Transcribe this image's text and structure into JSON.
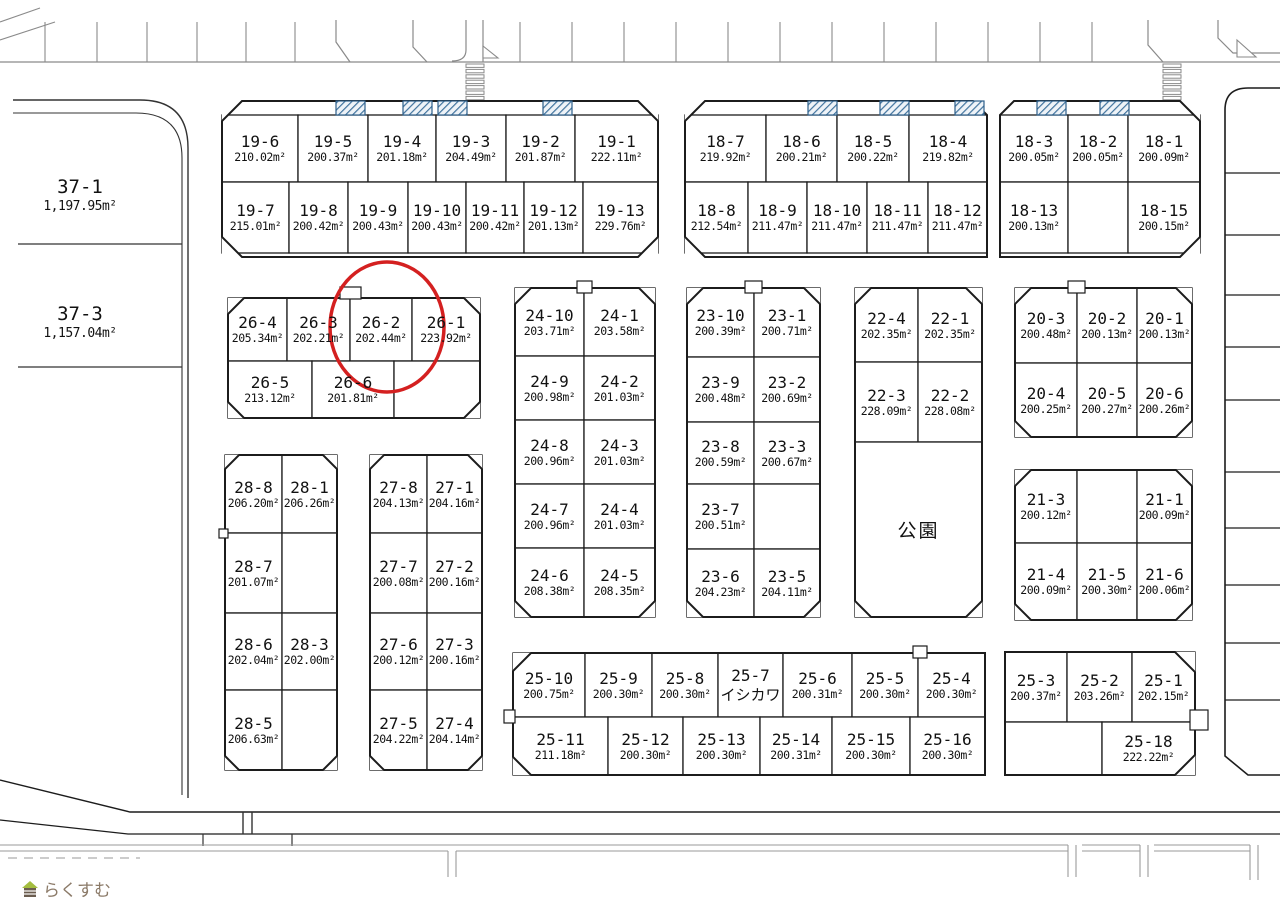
{
  "map": {
    "highlight_lot": "26-2",
    "park_label": "公園",
    "logo": {
      "text": "らくすむ"
    },
    "large_lots": [
      {
        "label": "37-1",
        "area": "1,197.95m²"
      },
      {
        "label": "37-3",
        "area": "1,157.04m²"
      }
    ],
    "blocks": [
      {
        "id": "19",
        "lots": [
          {
            "label": "19-6",
            "area": "210.02m²"
          },
          {
            "label": "19-5",
            "area": "200.37m²"
          },
          {
            "label": "19-4",
            "area": "201.18m²"
          },
          {
            "label": "19-3",
            "area": "204.49m²"
          },
          {
            "label": "19-2",
            "area": "201.87m²"
          },
          {
            "label": "19-1",
            "area": "222.11m²"
          },
          {
            "label": "19-7",
            "area": "215.01m²"
          },
          {
            "label": "19-8",
            "area": "200.42m²"
          },
          {
            "label": "19-9",
            "area": "200.43m²"
          },
          {
            "label": "19-10",
            "area": "200.43m²"
          },
          {
            "label": "19-11",
            "area": "200.42m²"
          },
          {
            "label": "19-12",
            "area": "201.13m²"
          },
          {
            "label": "19-13",
            "area": "229.76m²"
          }
        ]
      },
      {
        "id": "18-west",
        "lots": [
          {
            "label": "18-7",
            "area": "219.92m²"
          },
          {
            "label": "18-6",
            "area": "200.21m²"
          },
          {
            "label": "18-5",
            "area": "200.22m²"
          },
          {
            "label": "18-4",
            "area": "219.82m²"
          },
          {
            "label": "18-8",
            "area": "212.54m²"
          },
          {
            "label": "18-9",
            "area": "211.47m²"
          },
          {
            "label": "18-10",
            "area": "211.47m²"
          },
          {
            "label": "18-11",
            "area": "211.47m²"
          },
          {
            "label": "18-12",
            "area": "211.47m²"
          }
        ]
      },
      {
        "id": "18-east",
        "lots": [
          {
            "label": "18-3",
            "area": "200.05m²"
          },
          {
            "label": "18-2",
            "area": "200.05m²"
          },
          {
            "label": "18-1",
            "area": "200.09m²"
          },
          {
            "label": "18-13",
            "area": "200.13m²"
          },
          {
            "label": "18-15",
            "area": "200.15m²"
          }
        ]
      },
      {
        "id": "26",
        "lots": [
          {
            "label": "26-4",
            "area": "205.34m²"
          },
          {
            "label": "26-3",
            "area": "202.21m²"
          },
          {
            "label": "26-2",
            "area": "202.44m²"
          },
          {
            "label": "26-1",
            "area": "223.92m²"
          },
          {
            "label": "26-5",
            "area": "213.12m²"
          },
          {
            "label": "26-6",
            "area": "201.81m²"
          }
        ]
      },
      {
        "id": "24",
        "lots": [
          {
            "label": "24-10",
            "area": "203.71m²"
          },
          {
            "label": "24-1",
            "area": "203.58m²"
          },
          {
            "label": "24-9",
            "area": "200.98m²"
          },
          {
            "label": "24-2",
            "area": "201.03m²"
          },
          {
            "label": "24-8",
            "area": "200.96m²"
          },
          {
            "label": "24-3",
            "area": "201.03m²"
          },
          {
            "label": "24-7",
            "area": "200.96m²"
          },
          {
            "label": "24-4",
            "area": "201.03m²"
          },
          {
            "label": "24-6",
            "area": "208.38m²"
          },
          {
            "label": "24-5",
            "area": "208.35m²"
          }
        ]
      },
      {
        "id": "23",
        "lots": [
          {
            "label": "23-10",
            "area": "200.39m²"
          },
          {
            "label": "23-1",
            "area": "200.71m²"
          },
          {
            "label": "23-9",
            "area": "200.48m²"
          },
          {
            "label": "23-2",
            "area": "200.69m²"
          },
          {
            "label": "23-8",
            "area": "200.59m²"
          },
          {
            "label": "23-3",
            "area": "200.67m²"
          },
          {
            "label": "23-7",
            "area": "200.51m²"
          },
          {
            "label": "23-6",
            "area": "204.23m²"
          },
          {
            "label": "23-5",
            "area": "204.11m²"
          }
        ]
      },
      {
        "id": "22",
        "lots": [
          {
            "label": "22-4",
            "area": "202.35m²"
          },
          {
            "label": "22-1",
            "area": "202.35m²"
          },
          {
            "label": "22-3",
            "area": "228.09m²"
          },
          {
            "label": "22-2",
            "area": "228.08m²"
          }
        ]
      },
      {
        "id": "20",
        "lots": [
          {
            "label": "20-3",
            "area": "200.48m²"
          },
          {
            "label": "20-2",
            "area": "200.13m²"
          },
          {
            "label": "20-1",
            "area": "200.13m²"
          },
          {
            "label": "20-4",
            "area": "200.25m²"
          },
          {
            "label": "20-5",
            "area": "200.27m²"
          },
          {
            "label": "20-6",
            "area": "200.26m²"
          }
        ]
      },
      {
        "id": "21",
        "lots": [
          {
            "label": "21-3",
            "area": "200.12m²"
          },
          {
            "label": "21-1",
            "area": "200.09m²"
          },
          {
            "label": "21-4",
            "area": "200.09m²"
          },
          {
            "label": "21-5",
            "area": "200.30m²"
          },
          {
            "label": "21-6",
            "area": "200.06m²"
          }
        ]
      },
      {
        "id": "28",
        "lots": [
          {
            "label": "28-8",
            "area": "206.20m²"
          },
          {
            "label": "28-1",
            "area": "206.26m²"
          },
          {
            "label": "28-7",
            "area": "201.07m²"
          },
          {
            "label": "28-6",
            "area": "202.04m²"
          },
          {
            "label": "28-3",
            "area": "202.00m²"
          },
          {
            "label": "28-5",
            "area": "206.63m²"
          }
        ]
      },
      {
        "id": "27",
        "lots": [
          {
            "label": "27-8",
            "area": "204.13m²"
          },
          {
            "label": "27-1",
            "area": "204.16m²"
          },
          {
            "label": "27-7",
            "area": "200.08m²"
          },
          {
            "label": "27-2",
            "area": "200.16m²"
          },
          {
            "label": "27-6",
            "area": "200.12m²"
          },
          {
            "label": "27-3",
            "area": "200.16m²"
          },
          {
            "label": "27-5",
            "area": "204.22m²"
          },
          {
            "label": "27-4",
            "area": "204.14m²"
          }
        ]
      },
      {
        "id": "25-west",
        "lots": [
          {
            "label": "25-10",
            "area": "200.75m²"
          },
          {
            "label": "25-9",
            "area": "200.30m²"
          },
          {
            "label": "25-8",
            "area": "200.30m²"
          },
          {
            "label": "25-7",
            "note": "イシカワ"
          },
          {
            "label": "25-6",
            "area": "200.31m²"
          },
          {
            "label": "25-5",
            "area": "200.30m²"
          },
          {
            "label": "25-4",
            "area": "200.30m²"
          },
          {
            "label": "25-11",
            "area": "211.18m²"
          },
          {
            "label": "25-12",
            "area": "200.30m²"
          },
          {
            "label": "25-13",
            "area": "200.30m²"
          },
          {
            "label": "25-14",
            "area": "200.31m²"
          },
          {
            "label": "25-15",
            "area": "200.30m²"
          },
          {
            "label": "25-16",
            "area": "200.30m²"
          }
        ]
      },
      {
        "id": "25-east",
        "lots": [
          {
            "label": "25-3",
            "area": "200.37m²"
          },
          {
            "label": "25-2",
            "area": "203.26m²"
          },
          {
            "label": "25-1",
            "area": "202.15m²"
          },
          {
            "label": "25-18",
            "area": "222.22m²"
          }
        ]
      }
    ]
  }
}
